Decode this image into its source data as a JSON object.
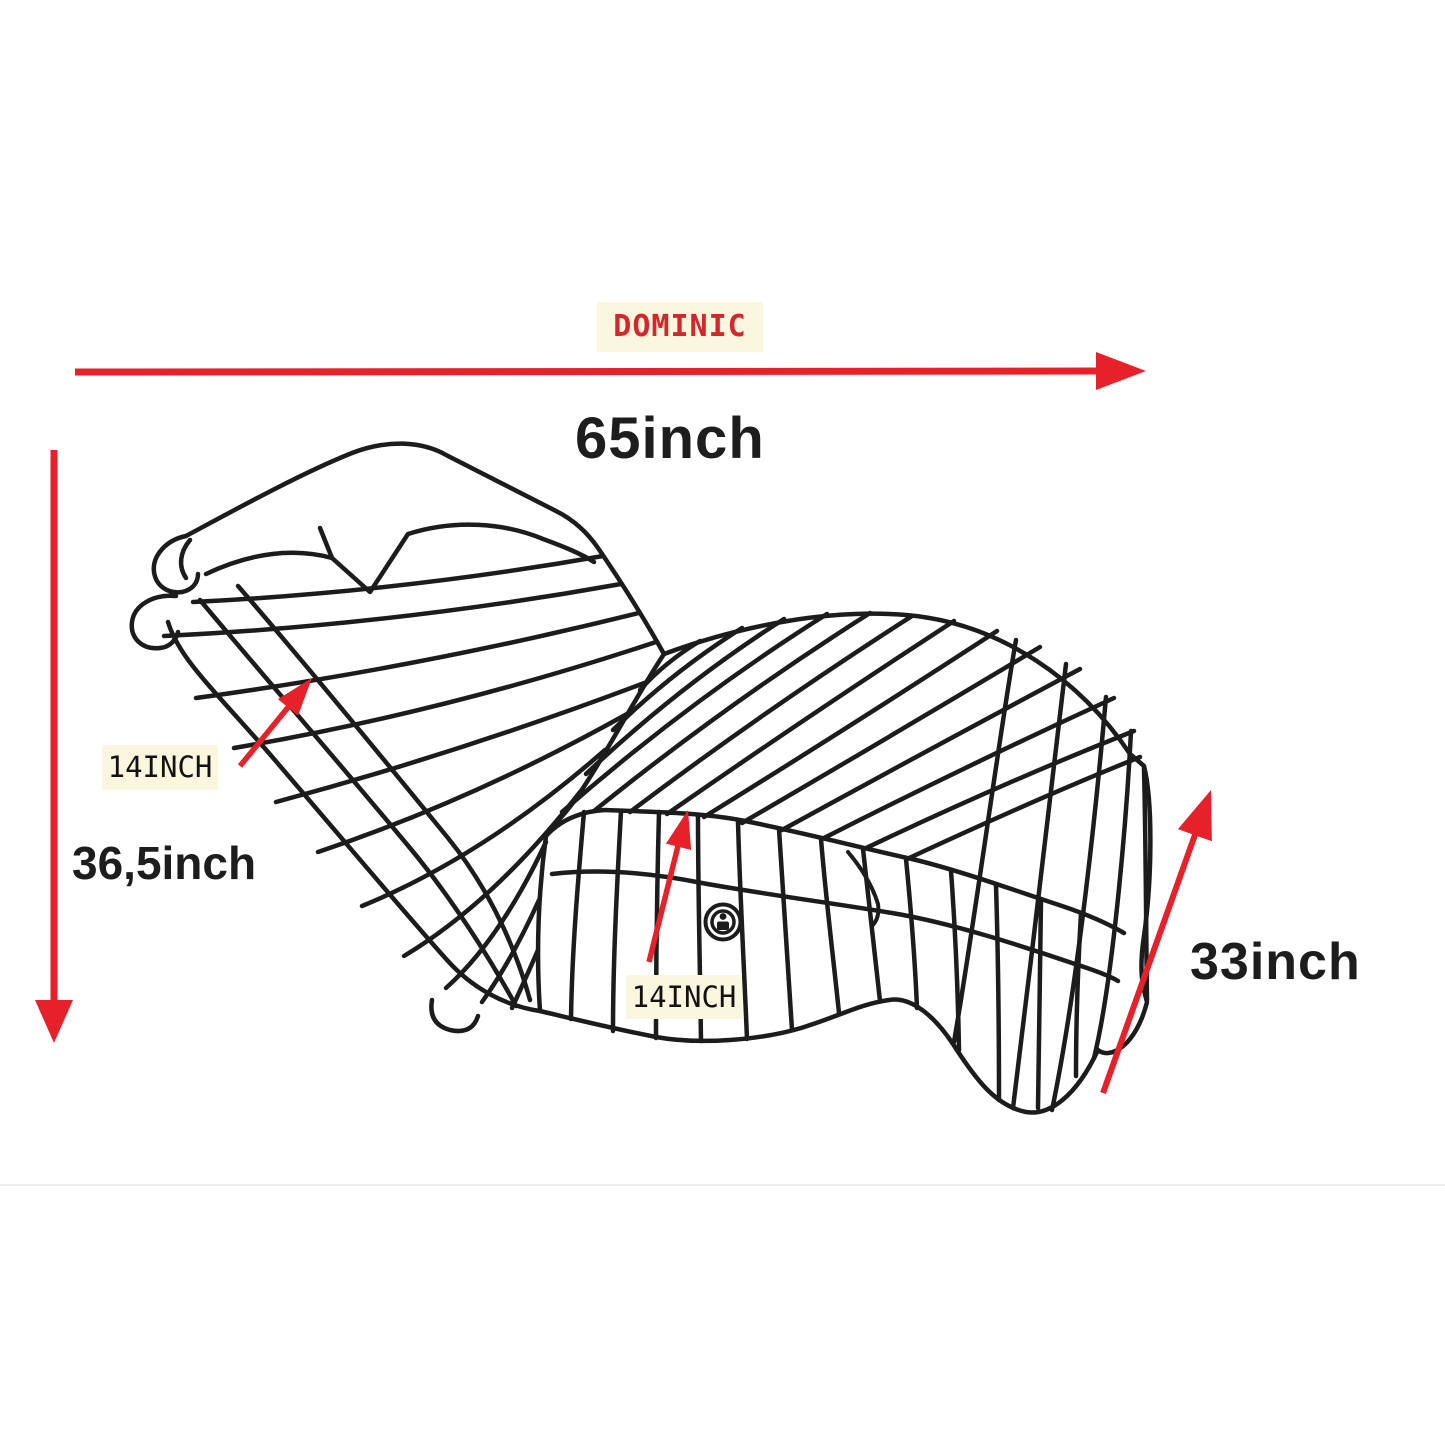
{
  "page": {
    "background_color": "#ffffff",
    "description": "Product dimension diagram of a striped chaise lounge cover"
  },
  "brand_label": {
    "text": "DOMINIC",
    "text_color": "#d5262c",
    "background_color": "#fbf6de"
  },
  "dimensions": {
    "width": {
      "text": "65inch",
      "arrow": "horizontal-top"
    },
    "height": {
      "text": "36,5inch",
      "arrow": "vertical-left"
    },
    "depth": {
      "text": "33inch",
      "arrow": "diagonal-right"
    },
    "back_thickness": {
      "text": "14INCH",
      "background_color": "#fbf6de",
      "arrow": "short-up-right-on-backrest"
    },
    "seat_thickness": {
      "text": "14INCH",
      "background_color": "#fbf6de",
      "arrow": "short-up-on-seat-skirt"
    }
  },
  "drawing": {
    "subject": "chaise-lounge-line-drawing",
    "line_color": "#1c1c1c",
    "arrow_color": "#e62129",
    "emblem": "button-emblem-on-seat-skirt"
  }
}
